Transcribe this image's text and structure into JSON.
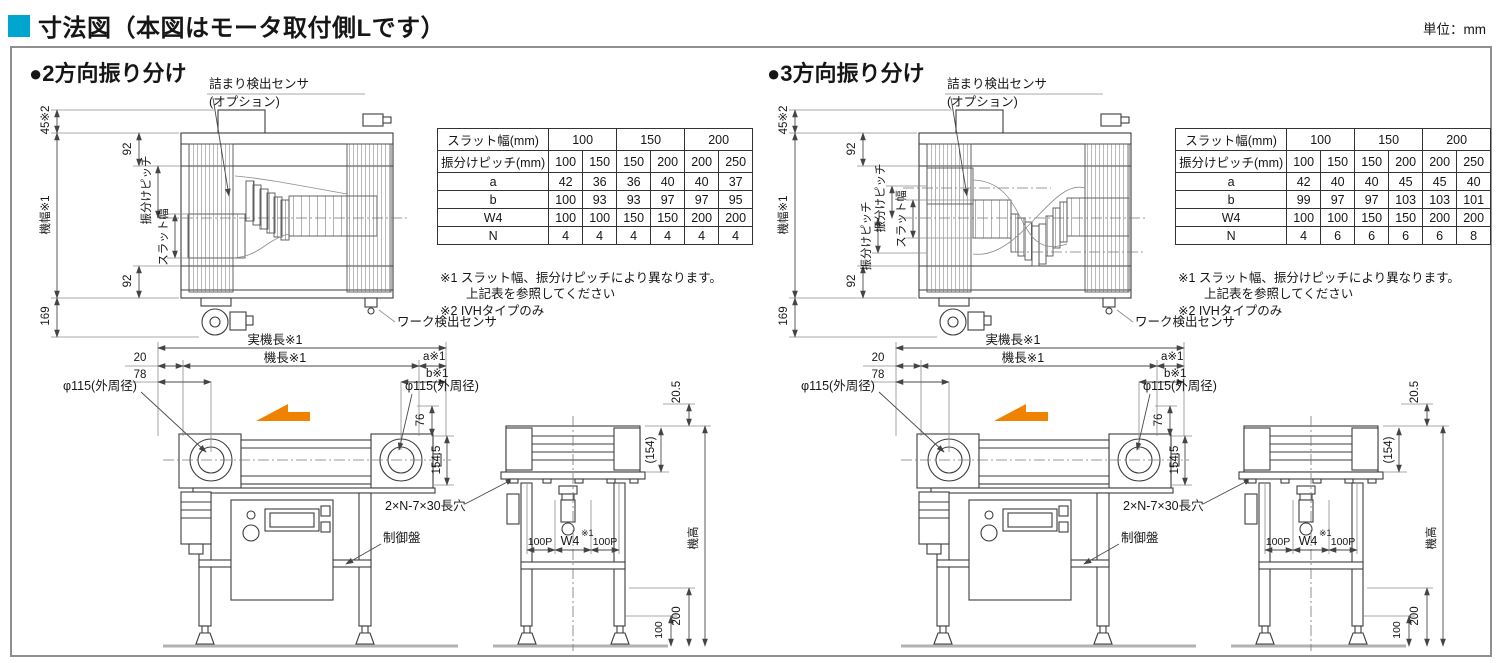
{
  "page": {
    "title": "寸法図（本図はモータ取付側Lです）",
    "unit": "単位：mm"
  },
  "colors": {
    "accent_cyan": "#00a6ce",
    "arrow_orange": "#ef8200"
  },
  "shared": {
    "labels": {
      "jam_sensor": "詰まり検出センサ",
      "jam_sensor_opt": "(オプション)",
      "work_sensor": "ワーク検出センサ",
      "slot_hole": "2×N-7×30長穴",
      "control_panel": "制御盤"
    },
    "dims": {
      "d45": "45※2",
      "d92": "92",
      "machine_width": "機幅※1",
      "pitch": "振分けピッチ",
      "slat_width": "スラット幅",
      "d169": "169",
      "actual_length": "実機長※1",
      "length": "機長※1",
      "d20": "20",
      "d78": "78",
      "a": "a※1",
      "b": "b※1",
      "dia": "φ115(外周径)",
      "d76": "76",
      "d154_5": "154.5",
      "d20_5": "20.5",
      "d154": "(154)",
      "machine_height": "機高",
      "d200": "200",
      "d100": "100",
      "p100": "100P",
      "w4": "W4",
      "sup1": "※1"
    },
    "notes": [
      "※1 スラット幅、振分けピッチにより異なります。",
      "上記表を参照してください",
      "※2 IVHタイプのみ"
    ]
  },
  "panels": [
    {
      "heading": "●2方向振り分け",
      "table": {
        "col1_header": "スラット幅(mm)",
        "col_groups": [
          "100",
          "150",
          "200"
        ],
        "pitch_label": "振分けピッチ(mm)",
        "pitch_values": [
          "100",
          "150",
          "150",
          "200",
          "200",
          "250"
        ],
        "rows": [
          {
            "label": "a",
            "values": [
              "42",
              "36",
              "36",
              "40",
              "40",
              "37"
            ]
          },
          {
            "label": "b",
            "values": [
              "100",
              "93",
              "93",
              "97",
              "97",
              "95"
            ]
          },
          {
            "label": "W4",
            "values": [
              "100",
              "100",
              "150",
              "150",
              "200",
              "200"
            ]
          },
          {
            "label": "N",
            "values": [
              "4",
              "4",
              "4",
              "4",
              "4",
              "4"
            ]
          }
        ]
      }
    },
    {
      "heading": "●3方向振り分け",
      "table": {
        "col1_header": "スラット幅(mm)",
        "col_groups": [
          "100",
          "150",
          "200"
        ],
        "pitch_label": "振分けピッチ(mm)",
        "pitch_values": [
          "100",
          "150",
          "150",
          "200",
          "200",
          "250"
        ],
        "rows": [
          {
            "label": "a",
            "values": [
              "42",
              "40",
              "40",
              "45",
              "45",
              "40"
            ]
          },
          {
            "label": "b",
            "values": [
              "99",
              "97",
              "97",
              "103",
              "103",
              "101"
            ]
          },
          {
            "label": "W4",
            "values": [
              "100",
              "100",
              "150",
              "150",
              "200",
              "200"
            ]
          },
          {
            "label": "N",
            "values": [
              "4",
              "6",
              "6",
              "6",
              "6",
              "8"
            ]
          }
        ]
      }
    }
  ]
}
